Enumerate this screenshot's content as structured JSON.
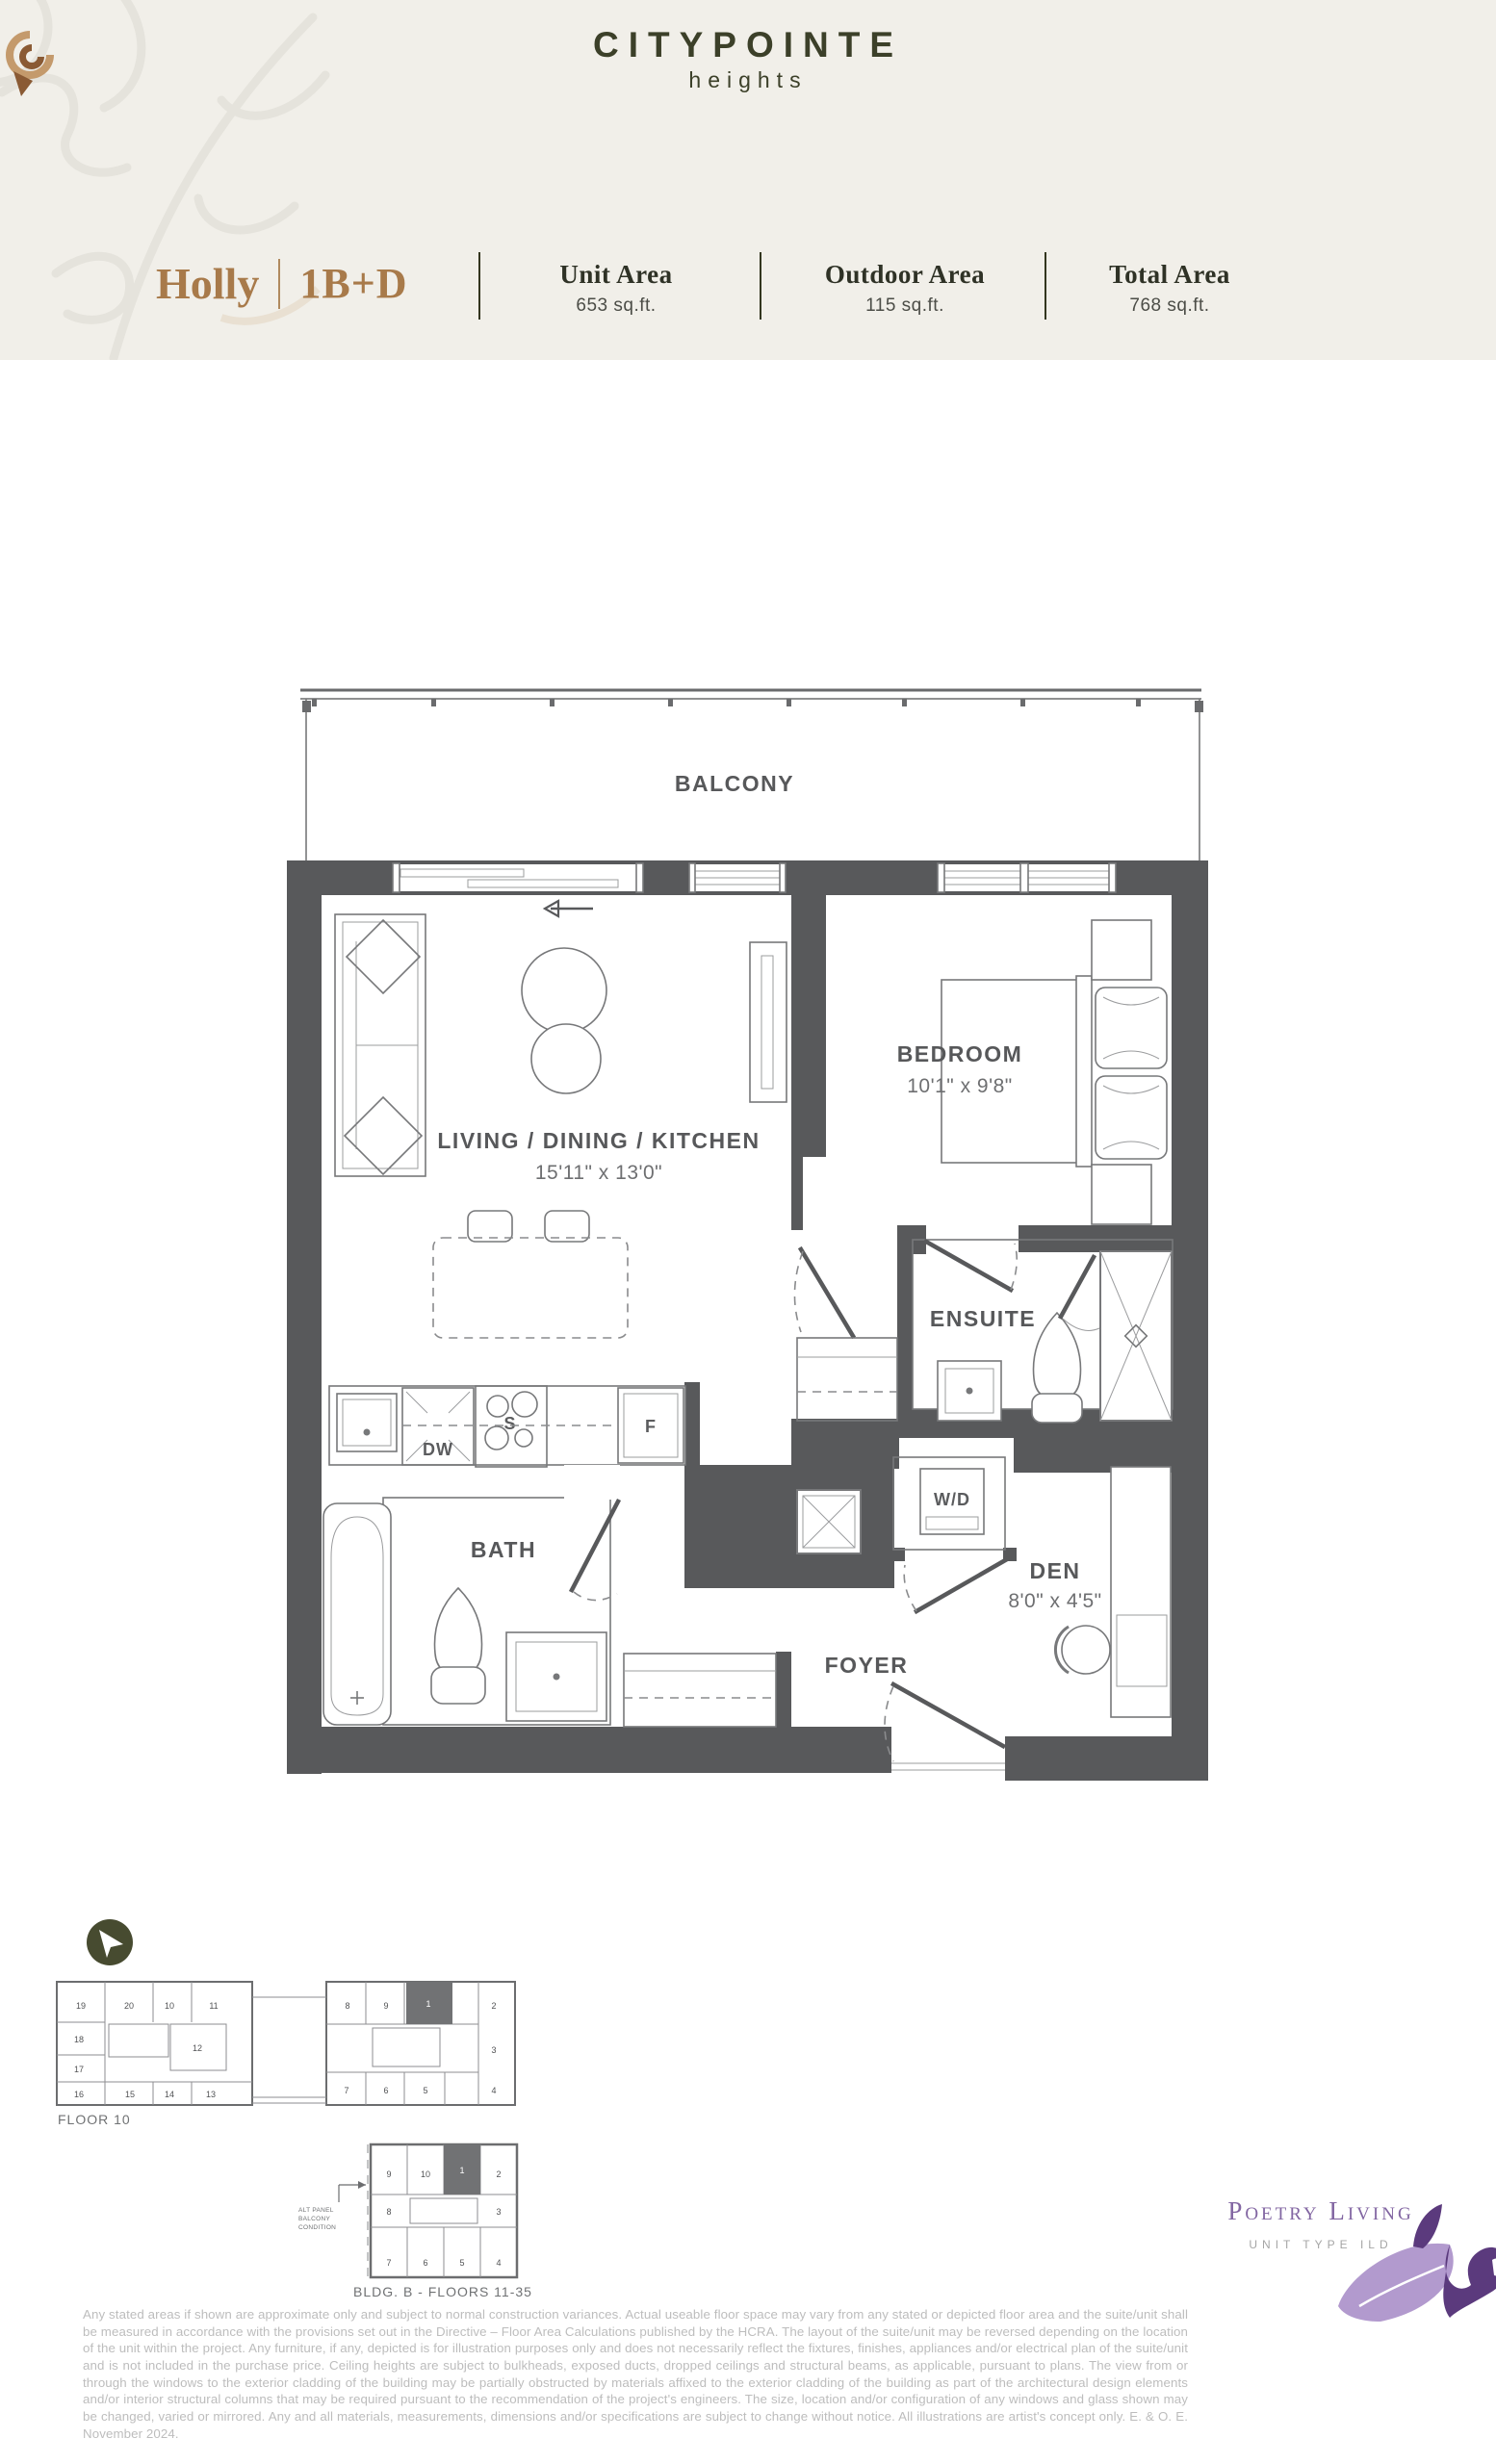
{
  "brand": {
    "name": "CITYPOINTE",
    "tagline": "heights"
  },
  "unit": {
    "name": "Holly",
    "type": "1B+D"
  },
  "stats": [
    {
      "label": "Unit Area",
      "value": "653 sq.ft."
    },
    {
      "label": "Outdoor Area",
      "value": "115 sq.ft."
    },
    {
      "label": "Total Area",
      "value": "768 sq.ft."
    }
  ],
  "floorplan": {
    "balcony": "BALCONY",
    "living": {
      "name": "LIVING / DINING / KITCHEN",
      "dim": "15'11\" x 13'0\""
    },
    "bedroom": {
      "name": "BEDROOM",
      "dim": "10'1\" x 9'8\""
    },
    "ensuite": "ENSUITE",
    "bath": "BATH",
    "den": {
      "name": "DEN",
      "dim": "8'0\" x 4'5\""
    },
    "foyer": "FOYER",
    "laundry": "W/D",
    "appliances": {
      "dishwasher": "DW",
      "stove": "S",
      "fridge": "F"
    }
  },
  "keyplans": [
    {
      "title": "FLOOR 10",
      "highlighted_unit": "1",
      "units": [
        "19",
        "20",
        "10",
        "11",
        "18",
        "12",
        "17",
        "16",
        "15",
        "14",
        "13",
        "8",
        "9",
        "1",
        "2",
        "3",
        "7",
        "6",
        "5",
        "4"
      ]
    },
    {
      "title": "BLDG. B - FLOORS 11-35",
      "highlighted_unit": "1",
      "note_lines": [
        "ALT PANEL",
        "BALCONY",
        "CONDITION"
      ],
      "units": [
        "9",
        "10",
        "1",
        "2",
        "8",
        "3",
        "7",
        "6",
        "5",
        "4"
      ]
    }
  ],
  "footer": {
    "disclaimer": "Any stated areas if shown are approximate only and subject to normal construction variances. Actual useable floor space may vary from any stated or depicted floor area and the suite/unit shall be measured in accordance with the provisions set out in the Directive – Floor Area Calculations published by the HCRA. The layout of the suite/unit may be reversed depending on the location of the unit within the project. Any furniture, if any, depicted is for illustration purposes only and does not necessarily reflect the fixtures, finishes, appliances and/or electrical plan of the suite/unit and is not included in the purchase price. Ceiling heights are subject to bulkheads, exposed ducts, dropped ceilings and structural beams, as applicable, pursuant to plans. The view from or through the windows to the exterior cladding of the building may be partially obstructed by materials affixed to the exterior cladding of the building as part of the architectural design elements and/or interior structural columns that may be required pursuant to the recommendation of the project's engineers. The size, location and/or configuration of any windows and glass shown may be changed, varied or mirrored. Any and all materials, measurements, dimensions and/or specifications are subject to change without notice. All illustrations are artist's concept only. E. & O. E. November 2024.",
    "developer": "Poetry Living",
    "unit_code": "UNIT TYPE ILD"
  },
  "colors": {
    "header_bg": "#f1efe9",
    "brand_olive": "#3c4029",
    "accent_brown": "#a87a4a",
    "wall_gray": "#58595b",
    "purple": "#8266a2"
  }
}
